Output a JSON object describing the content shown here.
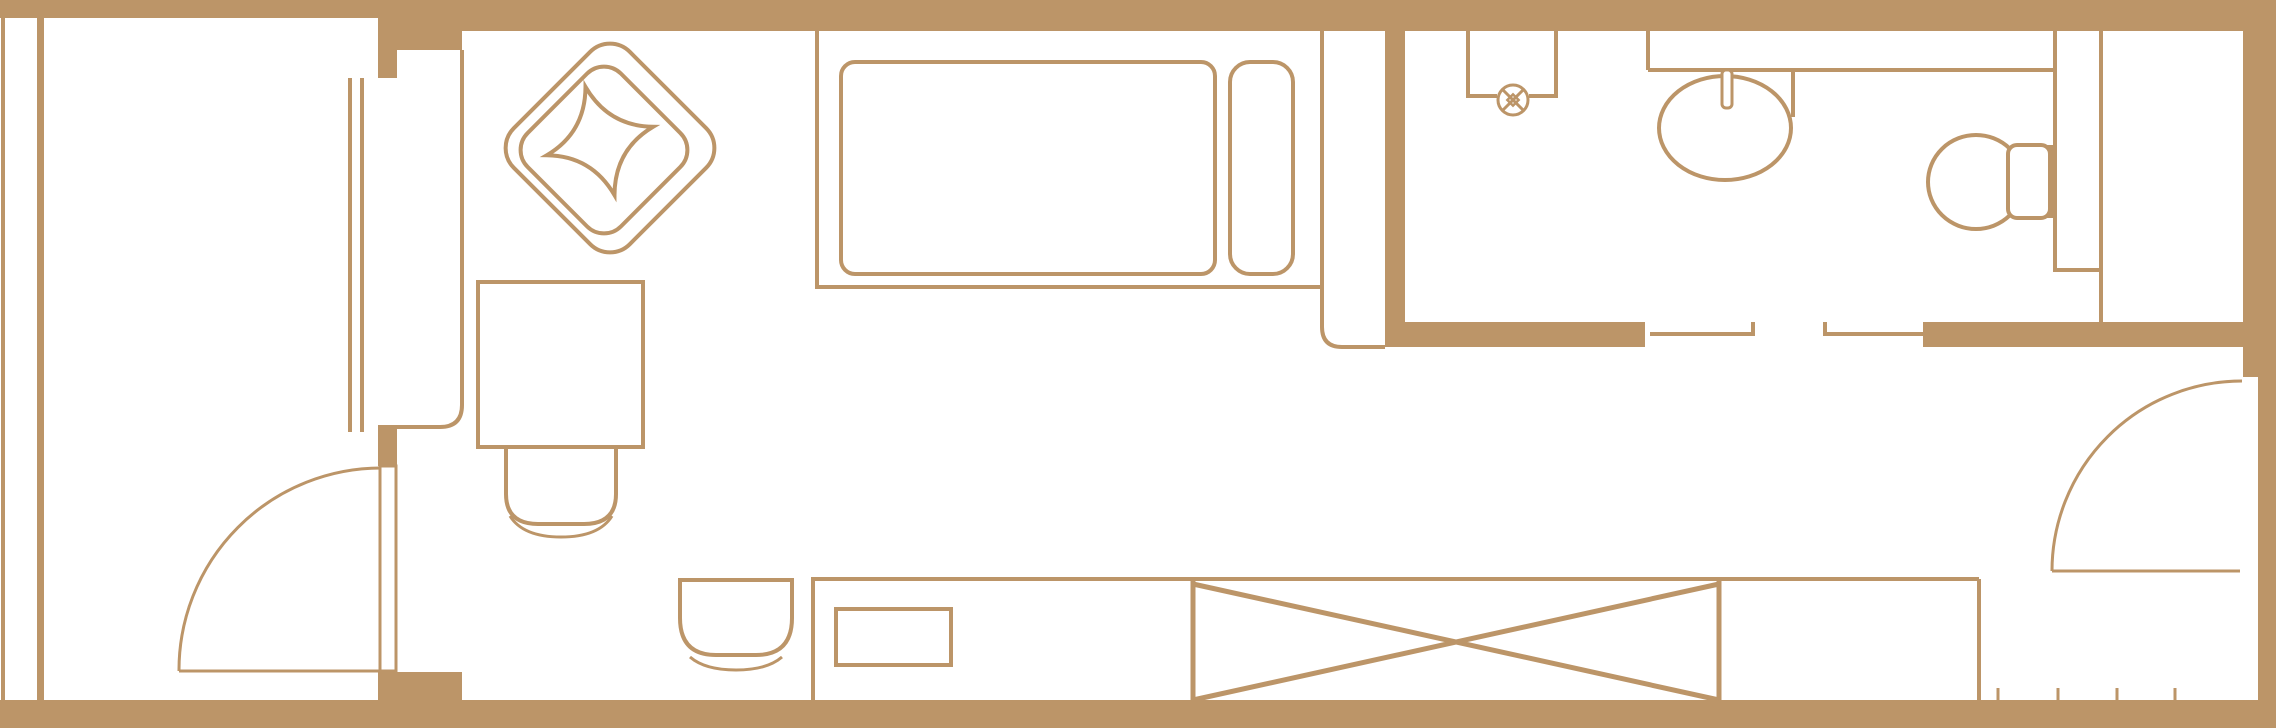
{
  "meta": {
    "title": "hotel-room-floor-plan",
    "canvas": {
      "width": 2276,
      "height": 728
    },
    "colors": {
      "ink": "#bc9568",
      "bg": "#ffffff"
    }
  },
  "rooms": [
    {
      "name": "balcony"
    },
    {
      "name": "living-sleeping-area"
    },
    {
      "name": "bathroom"
    },
    {
      "name": "entry-corridor"
    }
  ],
  "shapes": [
    {
      "name": "top-wall-balcony",
      "type": "rect",
      "fill": "ink",
      "attrs": {
        "x": 0,
        "y": 0,
        "width": 382,
        "height": 18
      }
    },
    {
      "name": "top-wall-main",
      "type": "rect",
      "fill": "ink",
      "attrs": {
        "x": 378,
        "y": 0,
        "width": 1898,
        "height": 31
      }
    },
    {
      "name": "window-pillar-block",
      "type": "rect",
      "fill": "ink",
      "attrs": {
        "x": 378,
        "y": 0,
        "width": 84,
        "height": 50
      }
    },
    {
      "name": "right-wall-upper",
      "type": "rect",
      "fill": "ink",
      "attrs": {
        "x": 2243,
        "y": 31,
        "width": 33,
        "height": 346
      }
    },
    {
      "name": "right-wall-lower",
      "type": "rect",
      "fill": "ink",
      "attrs": {
        "x": 2258,
        "y": 377,
        "width": 18,
        "height": 351
      }
    },
    {
      "name": "bottom-wall",
      "type": "rect",
      "fill": "ink",
      "attrs": {
        "x": 0,
        "y": 700,
        "width": 2276,
        "height": 28
      }
    },
    {
      "name": "balcony-door-sill-chunk",
      "type": "rect",
      "fill": "ink",
      "attrs": {
        "x": 378,
        "y": 672,
        "width": 84,
        "height": 30
      }
    },
    {
      "name": "left-facade-line",
      "type": "rect",
      "fill": "ink",
      "attrs": {
        "x": 1,
        "y": 18,
        "width": 4,
        "height": 687
      }
    },
    {
      "name": "balcony-parapet-line",
      "type": "rect",
      "fill": "ink",
      "attrs": {
        "x": 37,
        "y": 18,
        "width": 7,
        "height": 687
      }
    },
    {
      "name": "window-mullion-solid",
      "type": "rect",
      "fill": "ink",
      "attrs": {
        "x": 378,
        "y": 50,
        "width": 19,
        "height": 28
      }
    },
    {
      "name": "window-sill-block",
      "type": "rect",
      "fill": "ink",
      "attrs": {
        "x": 378,
        "y": 425,
        "width": 19,
        "height": 41
      }
    },
    {
      "name": "bath-divider-wall",
      "type": "rect",
      "fill": "ink",
      "attrs": {
        "x": 1385,
        "y": 31,
        "width": 20,
        "height": 316
      }
    },
    {
      "name": "bath-south-wall-left",
      "type": "rect",
      "fill": "ink",
      "attrs": {
        "x": 1400,
        "y": 322,
        "width": 245,
        "height": 25
      }
    },
    {
      "name": "bath-south-wall-right",
      "type": "rect",
      "fill": "ink",
      "attrs": {
        "x": 1923,
        "y": 322,
        "width": 353,
        "height": 25
      }
    },
    {
      "name": "window-glazing-outer",
      "type": "line",
      "stroke": "ink",
      "sw": 4,
      "attrs": {
        "x1": 350,
        "y1": 78,
        "x2": 350,
        "y2": 432
      }
    },
    {
      "name": "window-glazing-inner",
      "type": "line",
      "stroke": "ink",
      "sw": 4,
      "attrs": {
        "x1": 362,
        "y1": 78,
        "x2": 362,
        "y2": 432
      }
    },
    {
      "name": "tall-cabinet-outline",
      "type": "path",
      "stroke": "ink",
      "sw": 4,
      "attrs": {
        "d": "M 462,50 L 462,405 Q 462,427 440,427 L 397,427"
      }
    },
    {
      "name": "balcony-door-leaf",
      "type": "rect",
      "stroke": "ink",
      "sw": 3,
      "attrs": {
        "x": 380,
        "y": 466,
        "width": 16,
        "height": 205
      }
    },
    {
      "name": "balcony-door-chord",
      "type": "line",
      "stroke": "ink",
      "sw": 3,
      "attrs": {
        "x1": 179,
        "y1": 671,
        "x2": 380,
        "y2": 671
      }
    },
    {
      "name": "balcony-door-swing-arc",
      "type": "path",
      "stroke": "ink",
      "sw": 3,
      "attrs": {
        "d": "M 179,671 A 202,202 0 0 1 381,468"
      }
    },
    {
      "name": "bed-frame",
      "type": "path",
      "stroke": "ink",
      "sw": 4,
      "attrs": {
        "d": "M 817,31 L 817,287 L 1322,287 M 1322,31 L 1322,327 Q 1322,347 1342,347 L 1385,347"
      }
    },
    {
      "name": "bed-mattress",
      "type": "rect",
      "stroke": "ink",
      "sw": 4,
      "attrs": {
        "x": 841,
        "y": 62,
        "width": 374,
        "height": 212,
        "rx": 14
      }
    },
    {
      "name": "bed-pillow",
      "type": "rect",
      "stroke": "ink",
      "sw": 4,
      "attrs": {
        "x": 1230,
        "y": 62,
        "width": 63,
        "height": 212,
        "rx": 20
      }
    },
    {
      "name": "armchair-outer",
      "type": "rect",
      "stroke": "ink",
      "sw": 4,
      "attrs": {
        "x": 528,
        "y": 66,
        "width": 164,
        "height": 164,
        "rx": 28,
        "transform": "rotate(45 610 148)"
      }
    },
    {
      "name": "armchair-seat-line",
      "type": "rect",
      "stroke": "ink",
      "sw": 4,
      "attrs": {
        "x": 538,
        "y": 84,
        "width": 132,
        "height": 132,
        "rx": 24,
        "transform": "rotate(45 604 150)"
      }
    },
    {
      "name": "armchair-cushion",
      "type": "path",
      "stroke": "ink",
      "sw": 4,
      "attrs": {
        "d": "M 600,85 Q 588,129 545,141 Q 588,153 600,197 Q 612,153 655,141 Q 612,129 600,85 Z",
        "transform": "rotate(-15 600 141)"
      }
    },
    {
      "name": "side-table",
      "type": "rect",
      "stroke": "ink",
      "sw": 4,
      "attrs": {
        "x": 478,
        "y": 282,
        "width": 165,
        "height": 165
      }
    },
    {
      "name": "table-chair",
      "type": "path",
      "stroke": "ink",
      "sw": 4,
      "attrs": {
        "d": "M 506,447 L 506,494 Q 506,524 538,524 L 584,524 Q 616,524 616,494 L 616,447"
      }
    },
    {
      "name": "table-chair-base-line",
      "type": "path",
      "stroke": "ink",
      "sw": 3,
      "attrs": {
        "d": "M 510,516 Q 523,537 561,537 Q 599,537 612,516"
      }
    },
    {
      "name": "desk-chair",
      "type": "path",
      "stroke": "ink",
      "sw": 4,
      "attrs": {
        "d": "M 680,580 H 792 V 618 Q 792,655 756,655 H 716 Q 680,655 680,618 Z"
      }
    },
    {
      "name": "desk-chair-base-line",
      "type": "path",
      "stroke": "ink",
      "sw": 3,
      "attrs": {
        "d": "M 690,657 Q 705,670 736,670 Q 767,670 782,657"
      }
    },
    {
      "name": "counter-left-edge",
      "type": "line",
      "stroke": "ink",
      "sw": 4,
      "attrs": {
        "x1": 813,
        "y1": 577,
        "x2": 813,
        "y2": 700
      }
    },
    {
      "name": "counter-top-edge",
      "type": "line",
      "stroke": "ink",
      "sw": 4,
      "attrs": {
        "x1": 813,
        "y1": 579,
        "x2": 1979,
        "y2": 579
      }
    },
    {
      "name": "counter-right-edge",
      "type": "line",
      "stroke": "ink",
      "sw": 4,
      "attrs": {
        "x1": 1979,
        "y1": 579,
        "x2": 1979,
        "y2": 700
      }
    },
    {
      "name": "desk-drawer",
      "type": "rect",
      "stroke": "ink",
      "sw": 4,
      "attrs": {
        "x": 836,
        "y": 609,
        "width": 115,
        "height": 56
      }
    },
    {
      "name": "wardrobe-crossed-box",
      "type": "path",
      "stroke": "ink",
      "sw": 5,
      "attrs": {
        "d": "M 1193,581 V 700 M 1719,581 V 700 M 1193,584 L 1719,700 M 1193,700 L 1719,584"
      }
    },
    {
      "name": "shower-enclosure",
      "type": "path",
      "stroke": "ink",
      "sw": 4,
      "attrs": {
        "d": "M 1468,31 L 1468,96 L 1497,96 M 1529,96 L 1556,96 L 1556,31"
      }
    },
    {
      "name": "shower-valve-circle",
      "type": "circle",
      "stroke": "ink",
      "fill": "bg",
      "sw": 3,
      "attrs": {
        "cx": 1513,
        "cy": 100,
        "r": 15
      }
    },
    {
      "name": "shower-valve-cross",
      "type": "path",
      "stroke": "ink",
      "sw": 3,
      "attrs": {
        "d": "M 1502,89 L 1524,111 M 1524,89 L 1502,111"
      }
    },
    {
      "name": "shower-valve-center",
      "type": "rect",
      "stroke": "ink",
      "sw": 2.5,
      "attrs": {
        "x": 1509,
        "y": 96,
        "width": 8,
        "height": 8,
        "transform": "rotate(45 1513 100)"
      }
    },
    {
      "name": "vanity-left-edge",
      "type": "line",
      "stroke": "ink",
      "sw": 4,
      "attrs": {
        "x1": 1648,
        "y1": 31,
        "x2": 1648,
        "y2": 70
      }
    },
    {
      "name": "vanity-counter-edge",
      "type": "line",
      "stroke": "ink",
      "sw": 4,
      "attrs": {
        "x1": 1648,
        "y1": 70,
        "x2": 2055,
        "y2": 70
      }
    },
    {
      "name": "vanity-divider-edge",
      "type": "line",
      "stroke": "ink",
      "sw": 4,
      "attrs": {
        "x1": 1793,
        "y1": 70,
        "x2": 1793,
        "y2": 117
      }
    },
    {
      "name": "sink-basin",
      "type": "ellipse",
      "stroke": "ink",
      "fill": "bg",
      "sw": 4,
      "attrs": {
        "cx": 1725,
        "cy": 128,
        "rx": 66,
        "ry": 52
      }
    },
    {
      "name": "sink-faucet",
      "type": "rect",
      "stroke": "ink",
      "fill": "bg",
      "sw": 3,
      "attrs": {
        "x": 1722,
        "y": 70,
        "width": 10,
        "height": 38,
        "rx": 4
      }
    },
    {
      "name": "service-shaft",
      "type": "path",
      "stroke": "ink",
      "sw": 4,
      "attrs": {
        "d": "M 2055,31 V 270 H 2101 M 2101,31 V 322"
      }
    },
    {
      "name": "toilet-bowl",
      "type": "ellipse",
      "stroke": "ink",
      "fill": "bg",
      "sw": 4,
      "attrs": {
        "cx": 1976,
        "cy": 182,
        "rx": 48,
        "ry": 47
      }
    },
    {
      "name": "toilet-tank-mount",
      "type": "rect",
      "fill": "ink",
      "attrs": {
        "x": 2030,
        "y": 145,
        "width": 25,
        "height": 73
      }
    },
    {
      "name": "toilet-tank",
      "type": "rect",
      "stroke": "ink",
      "fill": "bg",
      "sw": 4,
      "attrs": {
        "x": 2008,
        "y": 145,
        "width": 42,
        "height": 73,
        "rx": 9
      }
    },
    {
      "name": "bath-door-threshold-1",
      "type": "line",
      "stroke": "ink",
      "sw": 4,
      "attrs": {
        "x1": 1650,
        "y1": 334,
        "x2": 1755,
        "y2": 334
      }
    },
    {
      "name": "bath-threshold-1-tick",
      "type": "line",
      "stroke": "ink",
      "sw": 4,
      "attrs": {
        "x1": 1753,
        "y1": 322,
        "x2": 1753,
        "y2": 336
      }
    },
    {
      "name": "bath-door-threshold-2",
      "type": "line",
      "stroke": "ink",
      "sw": 4,
      "attrs": {
        "x1": 1823,
        "y1": 334,
        "x2": 1923,
        "y2": 334
      }
    },
    {
      "name": "bath-threshold-2-tick",
      "type": "line",
      "stroke": "ink",
      "sw": 4,
      "attrs": {
        "x1": 1825,
        "y1": 322,
        "x2": 1825,
        "y2": 336
      }
    },
    {
      "name": "entry-door-chord",
      "type": "line",
      "stroke": "ink",
      "sw": 3,
      "attrs": {
        "x1": 2052,
        "y1": 571,
        "x2": 2240,
        "y2": 571
      }
    },
    {
      "name": "entry-door-swing-arc",
      "type": "path",
      "stroke": "ink",
      "sw": 3,
      "attrs": {
        "d": "M 2052,571 A 190,190 0 0 1 2242,381"
      }
    },
    {
      "name": "entry-rack-tick-1",
      "type": "line",
      "stroke": "ink",
      "sw": 3,
      "attrs": {
        "x1": 1998,
        "y1": 688,
        "x2": 1998,
        "y2": 700
      }
    },
    {
      "name": "entry-rack-tick-2",
      "type": "line",
      "stroke": "ink",
      "sw": 3,
      "attrs": {
        "x1": 2058,
        "y1": 688,
        "x2": 2058,
        "y2": 700
      }
    },
    {
      "name": "entry-rack-tick-3",
      "type": "line",
      "stroke": "ink",
      "sw": 3,
      "attrs": {
        "x1": 2117,
        "y1": 688,
        "x2": 2117,
        "y2": 700
      }
    },
    {
      "name": "entry-rack-tick-4",
      "type": "line",
      "stroke": "ink",
      "sw": 3,
      "attrs": {
        "x1": 2175,
        "y1": 688,
        "x2": 2175,
        "y2": 700
      }
    }
  ]
}
